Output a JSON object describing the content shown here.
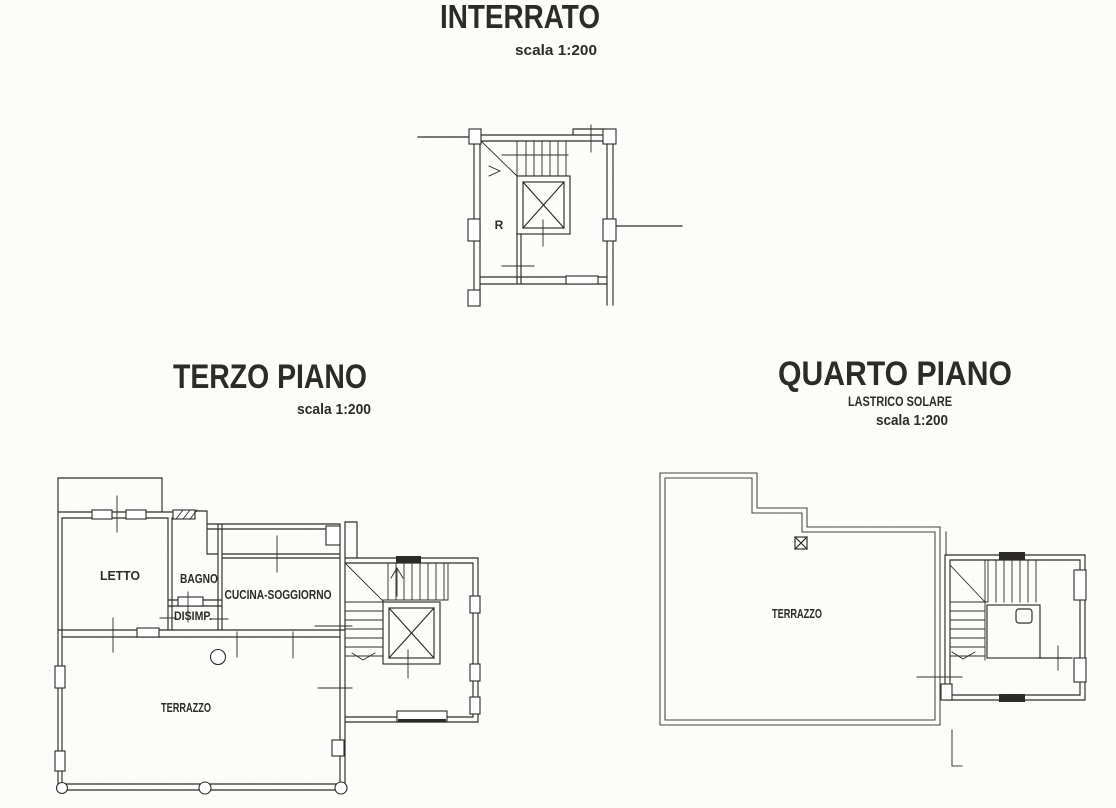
{
  "colors": {
    "ink": "#2c2b28",
    "ink_faint": "#45443f",
    "paper": "#fcfcfa"
  },
  "plans": {
    "interrato": {
      "title": "INTERRATO",
      "scale_label": "scala 1:200",
      "room_labels": {
        "r": "R"
      }
    },
    "terzo_piano": {
      "title": "TERZO PIANO",
      "scale_label": "scala 1:200",
      "room_labels": {
        "letto": "LETTO",
        "bagno": "BAGNO",
        "disimp": "DISIMP.",
        "cucina_soggiorno": "CUCINA-SOGGIORNO",
        "terrazzo": "TERRAZZO"
      }
    },
    "quarto_piano": {
      "title": "QUARTO PIANO",
      "subtitle": "LASTRICO SOLARE",
      "scale_label": "scala 1:200",
      "room_labels": {
        "terrazzo": "TERRAZZO"
      }
    }
  }
}
